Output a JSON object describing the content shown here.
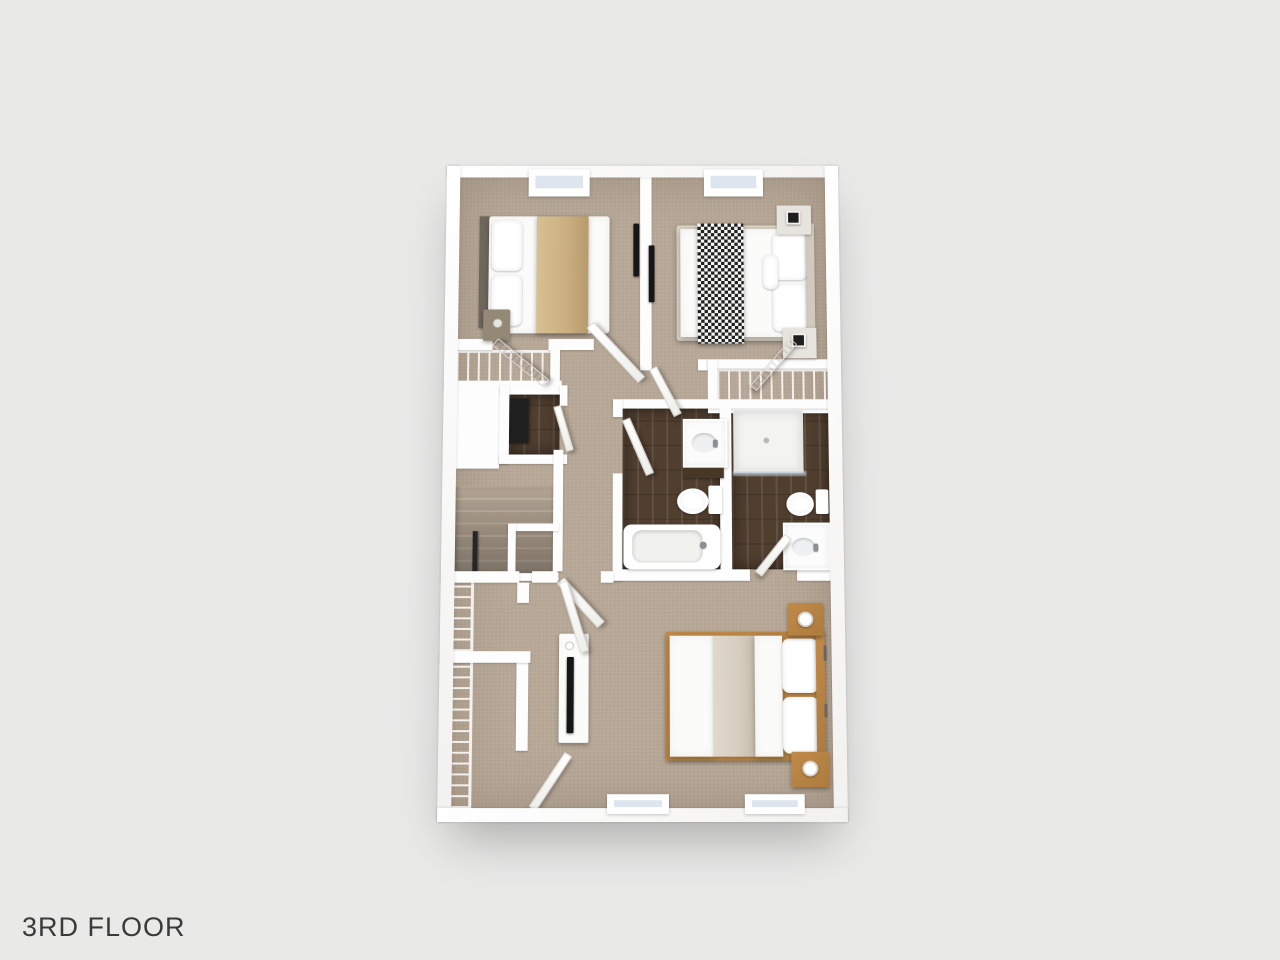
{
  "label": {
    "text": "3RD FLOOR"
  },
  "colors": {
    "background": "#e9e9e8",
    "label_text": "#3a3a3a",
    "wall": "#fdfdfd",
    "wall_shadow": "#d7d5d2",
    "carpet": "#b5a695",
    "carpet_light": "#c2b5a4",
    "wood_floor": "#503e2f",
    "wood_plank": "#63503f",
    "wood_furniture": "#ad7b3e",
    "bedding_white": "#fbfbf9",
    "throw_tan": "#c9ae81",
    "runner_greige": "#d7cec1",
    "check_dark": "#202020",
    "check_light": "#f6f6f4",
    "headboard_dark": "#6f675c",
    "headboard_light": "#d0c9bc",
    "tv_black": "#161616",
    "glass_blue": "#dde6ee",
    "fixture_white": "#fcfcfc",
    "rail_dark": "#262626",
    "appliance_dark": "#1f1f1f",
    "shelf_dark": "#493726",
    "wire_white": "#f7f6f3"
  }
}
